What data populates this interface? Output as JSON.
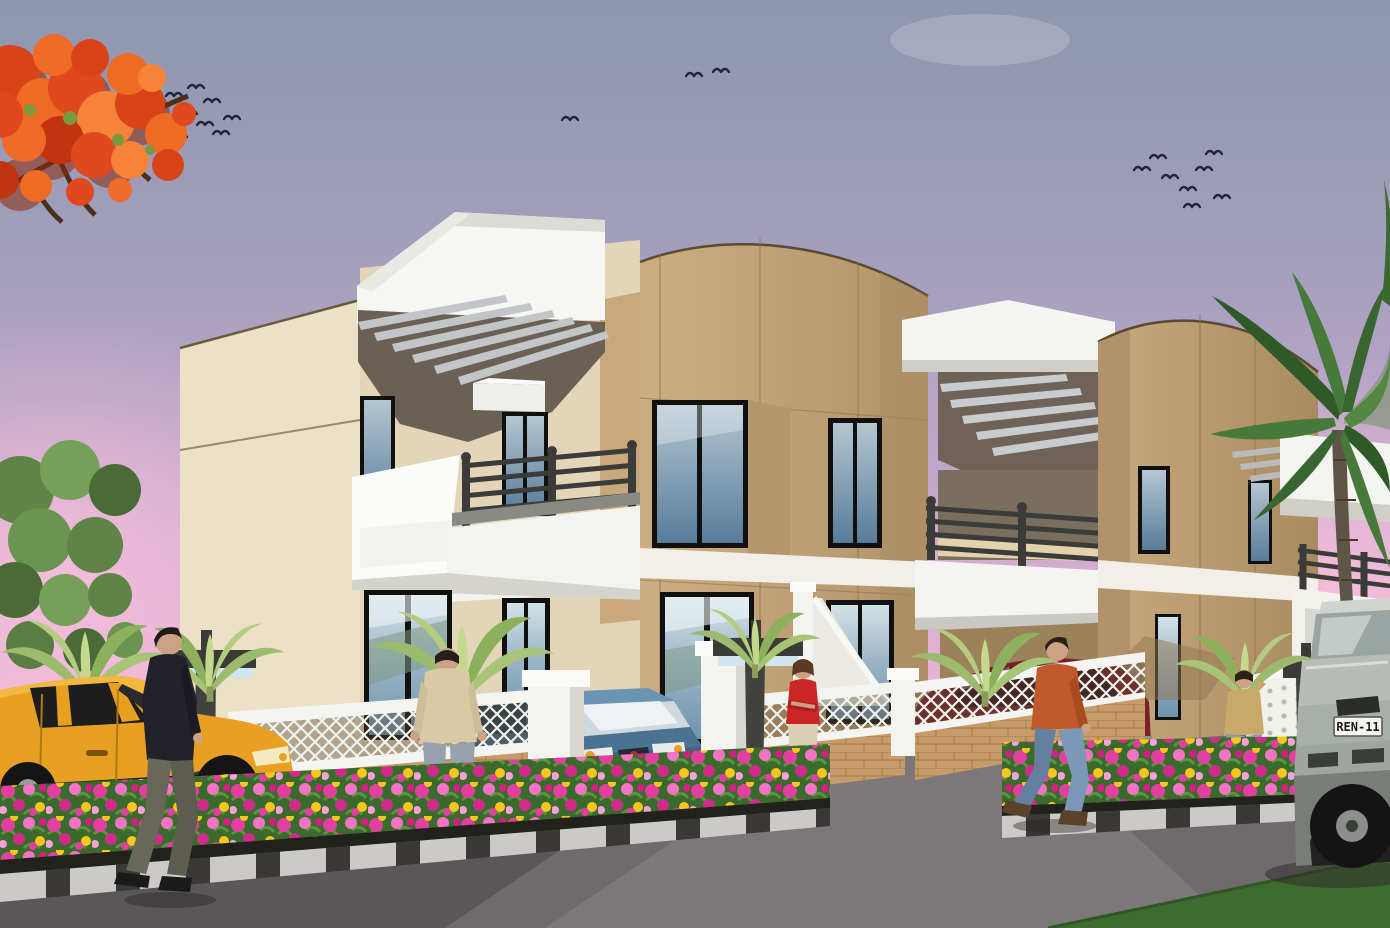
{
  "scene": {
    "type": "architectural-3d-render",
    "description": "Exterior daytime rendering of a row of two-storey beige townhouses with white parapets, pergolas and balconies, compound fence, flowering street beds, parked cars and pedestrians under a pink-violet sky",
    "license_plate": "REN-11",
    "counts": {
      "housing_units": 3,
      "pedestrians": 5,
      "cars": 4,
      "street_lamps": 3,
      "bird_flocks": 3
    },
    "palette": {
      "sky_top": "#8e96af",
      "sky_mid": "#c3a7cb",
      "sky_pink": "#f8c9de",
      "wall_cream": "#e8dcc0",
      "wall_tan": "#c4a378",
      "trim_white": "#f5f5f2",
      "pergola_shadow": "#6b6054",
      "railing_dark": "#3b3b39",
      "glass_blue": "#5a7e9c",
      "flame_tree_orange": "#e0481f",
      "palm_green": "#47793a",
      "banana_green": "#a8c476",
      "flower_magenta": "#e23fa0",
      "flower_yellow": "#f7c71f",
      "leaf_green": "#3a6b2c",
      "brick_sand": "#c79c6a",
      "road_grey": "#6f6a6c",
      "grass_green": "#3e6c2f",
      "car_yellow": "#e8a023",
      "car_blue": "#4a7392",
      "car_maroon": "#7a2026",
      "car_silver": "#b7bdb6",
      "skin": "#cda184",
      "shirt_red": "#cc2525",
      "shirt_orange": "#c05a2a",
      "shirt_beige": "#d9c9a5",
      "jeans_blue": "#8a9cb0"
    },
    "objects": [
      "flame-tree",
      "bird-flocks",
      "row-houses",
      "palm-tree",
      "street-lamps",
      "compound-fence",
      "gate-pillars",
      "entrance-gable",
      "banana-plants",
      "flower-beds",
      "kerb",
      "pedestrians",
      "parked-cars",
      "road",
      "driveway",
      "grass-verge"
    ]
  }
}
